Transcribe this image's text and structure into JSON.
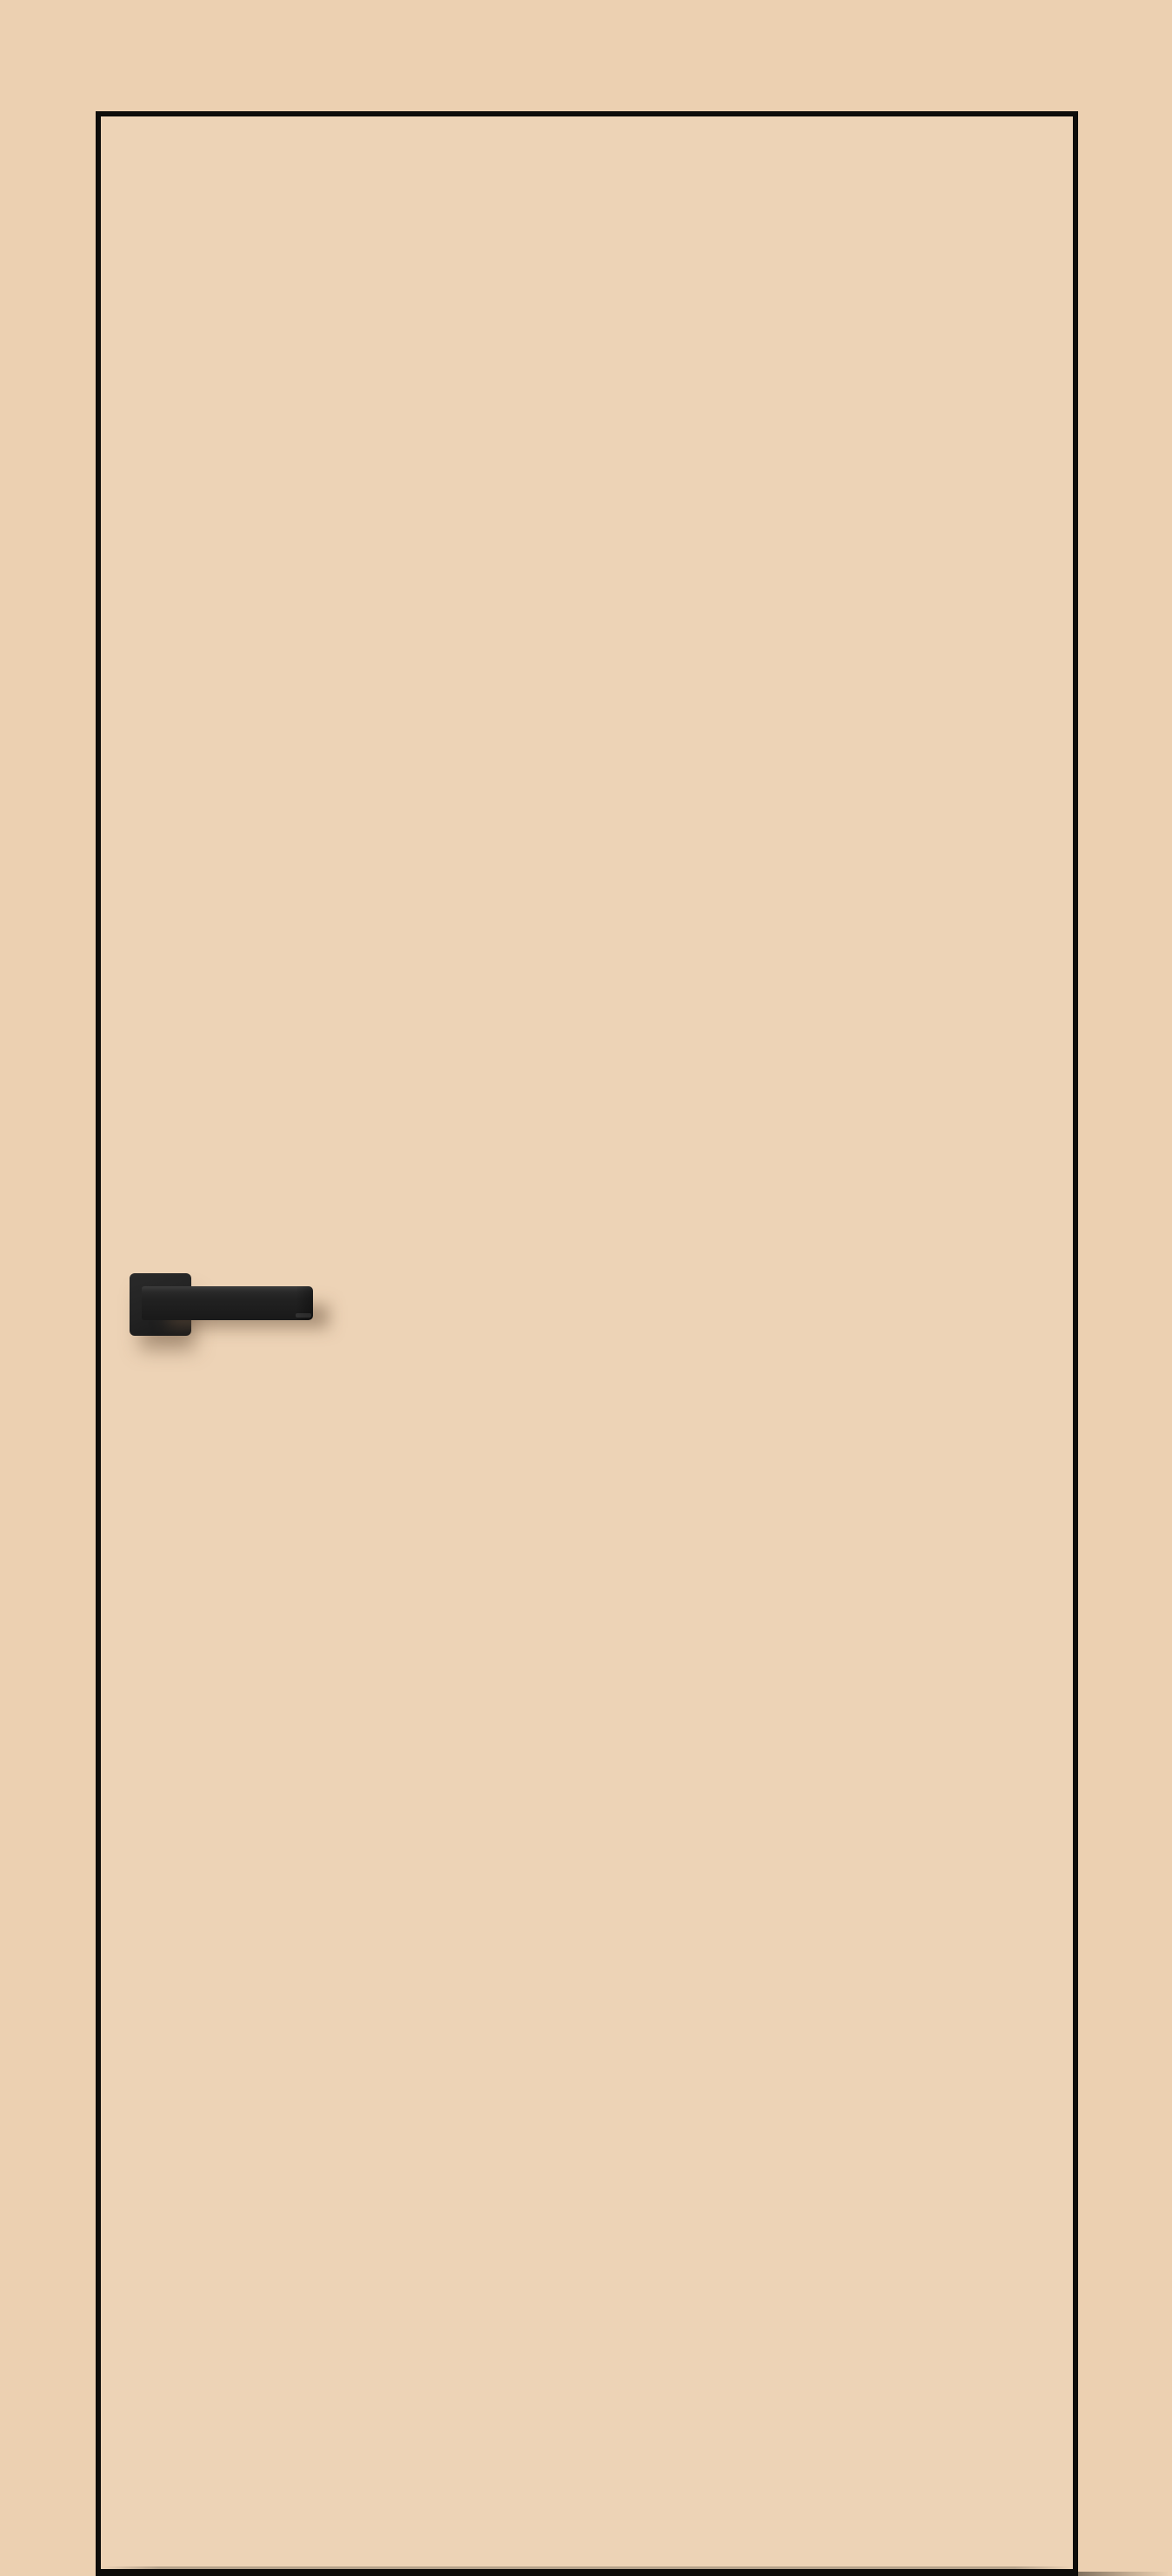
{
  "colors": {
    "background": "#ecd0b1",
    "door_fill": "#edd3b6",
    "outline": "#0d0c0a",
    "handle_top": "#3c3c3c",
    "handle_mid": "#2a2a2a",
    "handle_body": "#222222",
    "handle_dark": "#191919",
    "shadow": "rgba(106,82,60,0.5)"
  },
  "icons": {
    "door": "door-leaf",
    "handle": "door-handle"
  }
}
